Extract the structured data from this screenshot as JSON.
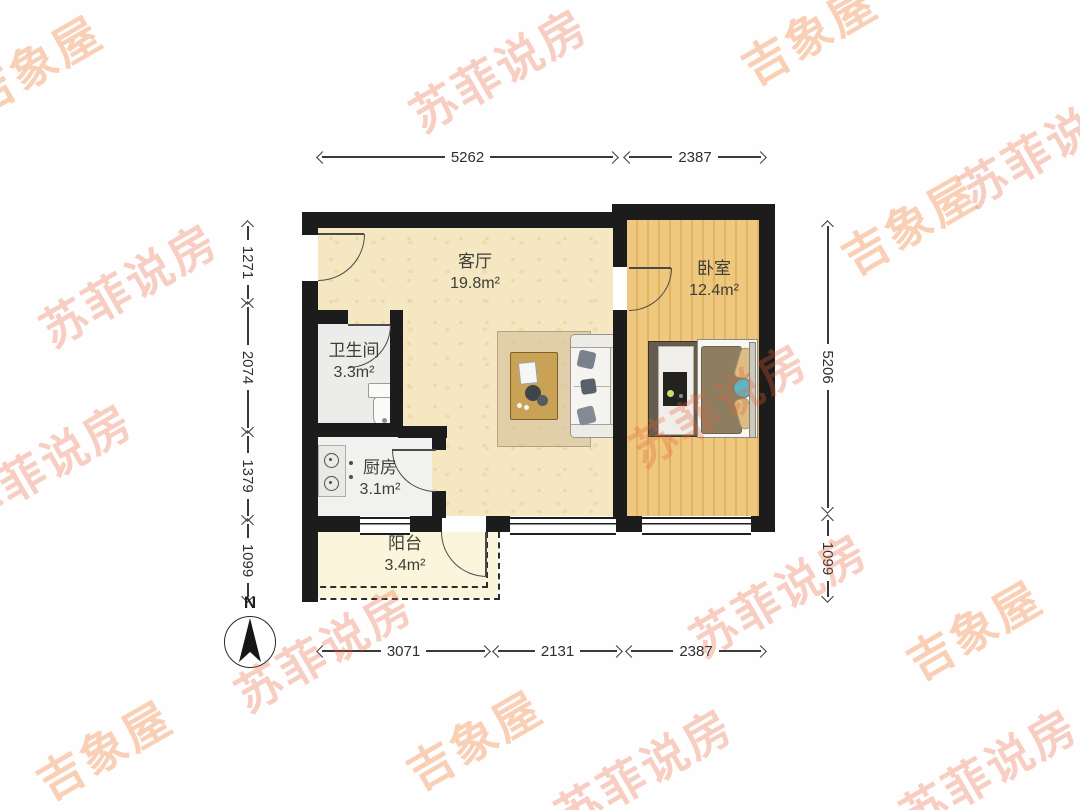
{
  "rooms": {
    "living": {
      "name": "客厅",
      "area": "19.8m²"
    },
    "bedroom": {
      "name": "卧室",
      "area": "12.4m²"
    },
    "bathroom": {
      "name": "卫生间",
      "area": "3.3m²"
    },
    "kitchen": {
      "name": "厨房",
      "area": "3.1m²"
    },
    "balcony": {
      "name": "阳台",
      "area": "3.4m²"
    }
  },
  "dimensions": {
    "top": [
      "5262",
      "2387"
    ],
    "bottom": [
      "3071",
      "2131",
      "2387"
    ],
    "left": [
      "1271",
      "2074",
      "1379",
      "1099"
    ],
    "right": [
      "5206",
      "1099"
    ]
  },
  "compass": {
    "north_label": "N"
  },
  "watermarks": {
    "sufei": "苏菲说房",
    "jixiang": "吉象屋"
  },
  "colors": {
    "wall": "#1c1c1c",
    "living_floor": "#f4e7c1",
    "bedroom_floor": "#eac472",
    "wet_room_floor": "#ececea",
    "balcony_floor": "#fbf5dc",
    "watermark_orange": "#ee7846"
  }
}
